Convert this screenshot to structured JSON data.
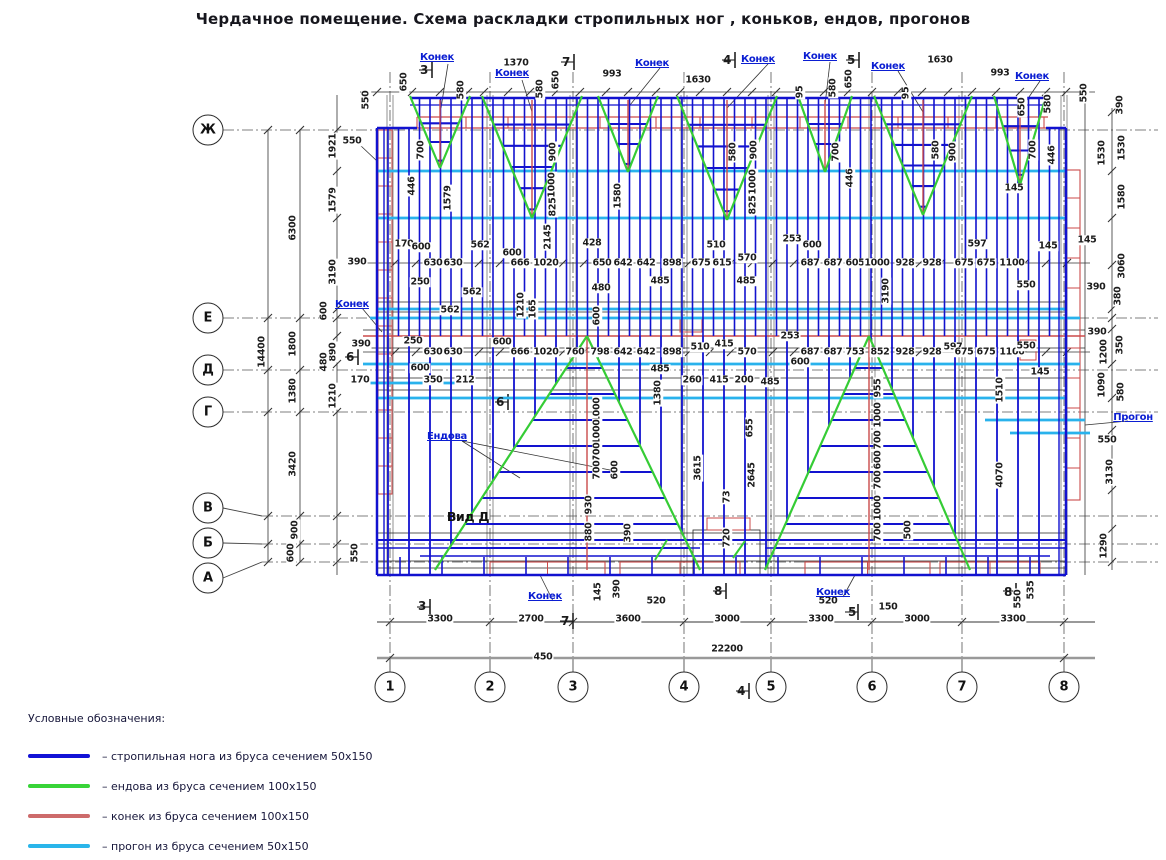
{
  "title": "Чердачное помещение. Схема раскладки стропильных ног , коньков, ендов, прогонов",
  "colors": {
    "rafter": "#1212cf",
    "valley": "#35cc35",
    "ridge": "#cb4a4a",
    "purlin": "#29b2ec",
    "legend_rafter": "#1212d6",
    "legend_valley": "#38d438",
    "legend_ridge": "#cd6b6b",
    "legend_purlin": "#2ab5ea"
  },
  "axes": {
    "rows": [
      {
        "label": "Ж",
        "cx": 208,
        "cy": 130,
        "y": 130
      },
      {
        "label": "Е",
        "cx": 208,
        "cy": 318,
        "y": 318
      },
      {
        "label": "Д",
        "cx": 208,
        "cy": 370,
        "y": 370
      },
      {
        "label": "Г",
        "cx": 208,
        "cy": 412,
        "y": 412
      },
      {
        "label": "В",
        "cx": 208,
        "cy": 508,
        "y": 516
      },
      {
        "label": "Б",
        "cx": 208,
        "cy": 543,
        "y": 544
      },
      {
        "label": "А",
        "cx": 208,
        "cy": 578,
        "y": 562
      }
    ],
    "cols": [
      {
        "label": "1",
        "x": 390
      },
      {
        "label": "2",
        "x": 490
      },
      {
        "label": "3",
        "x": 573
      },
      {
        "label": "4",
        "x": 684
      },
      {
        "label": "5",
        "x": 771
      },
      {
        "label": "6",
        "x": 872
      },
      {
        "label": "7",
        "x": 962
      },
      {
        "label": "8",
        "x": 1064
      }
    ]
  },
  "annotations": [
    {
      "t": "550",
      "x": 366,
      "y": 100,
      "v": 1
    },
    {
      "t": "650",
      "x": 404,
      "y": 82,
      "v": 1
    },
    {
      "t": "580",
      "x": 461,
      "y": 90,
      "v": 1
    },
    {
      "t": "1370",
      "x": 516,
      "y": 63
    },
    {
      "t": "Конек",
      "x": 437,
      "y": 58,
      "c": "b"
    },
    {
      "t": "Конек",
      "x": 512,
      "y": 74,
      "c": "b"
    },
    {
      "t": "580",
      "x": 540,
      "y": 89,
      "v": 1
    },
    {
      "t": "650",
      "x": 556,
      "y": 80,
      "v": 1
    },
    {
      "t": "993",
      "x": 612,
      "y": 74
    },
    {
      "t": "Конек",
      "x": 652,
      "y": 64,
      "c": "b"
    },
    {
      "t": "1630",
      "x": 698,
      "y": 80
    },
    {
      "t": "Конек",
      "x": 758,
      "y": 60,
      "c": "b"
    },
    {
      "t": "Конек",
      "x": 820,
      "y": 57,
      "c": "b"
    },
    {
      "t": "95",
      "x": 800,
      "y": 92,
      "v": 1
    },
    {
      "t": "580",
      "x": 833,
      "y": 88,
      "v": 1
    },
    {
      "t": "650",
      "x": 849,
      "y": 79,
      "v": 1
    },
    {
      "t": "Конек",
      "x": 888,
      "y": 67,
      "c": "b"
    },
    {
      "t": "95",
      "x": 906,
      "y": 93,
      "v": 1
    },
    {
      "t": "1630",
      "x": 940,
      "y": 60
    },
    {
      "t": "993",
      "x": 1000,
      "y": 73
    },
    {
      "t": "Конек",
      "x": 1032,
      "y": 77,
      "c": "b"
    },
    {
      "t": "650",
      "x": 1022,
      "y": 107,
      "v": 1
    },
    {
      "t": "580",
      "x": 1048,
      "y": 104,
      "v": 1
    },
    {
      "t": "550",
      "x": 1084,
      "y": 93,
      "v": 1
    },
    {
      "t": "3",
      "x": 424,
      "y": 70,
      "c": "s"
    },
    {
      "t": "7",
      "x": 566,
      "y": 62,
      "c": "s"
    },
    {
      "t": "4",
      "x": 727,
      "y": 60,
      "c": "s"
    },
    {
      "t": "5",
      "x": 851,
      "y": 60,
      "c": "s"
    },
    {
      "t": "14400",
      "x": 262,
      "y": 352,
      "v": 1
    },
    {
      "t": "6300",
      "x": 293,
      "y": 228,
      "v": 1
    },
    {
      "t": "1800",
      "x": 293,
      "y": 344,
      "v": 1
    },
    {
      "t": "1380",
      "x": 293,
      "y": 391,
      "v": 1
    },
    {
      "t": "3420",
      "x": 293,
      "y": 464,
      "v": 1
    },
    {
      "t": "900",
      "x": 295,
      "y": 530,
      "v": 1
    },
    {
      "t": "600",
      "x": 291,
      "y": 553,
      "v": 1
    },
    {
      "t": "1921",
      "x": 333,
      "y": 146,
      "v": 1
    },
    {
      "t": "1579",
      "x": 333,
      "y": 200,
      "v": 1
    },
    {
      "t": "3190",
      "x": 333,
      "y": 272,
      "v": 1
    },
    {
      "t": "600",
      "x": 324,
      "y": 311,
      "v": 1
    },
    {
      "t": "890",
      "x": 333,
      "y": 352,
      "v": 1
    },
    {
      "t": "480",
      "x": 324,
      "y": 362,
      "v": 1
    },
    {
      "t": "1210",
      "x": 333,
      "y": 396,
      "v": 1
    },
    {
      "t": "550",
      "x": 352,
      "y": 141
    },
    {
      "t": "550",
      "x": 355,
      "y": 553,
      "v": 1
    },
    {
      "t": "390",
      "x": 357,
      "y": 262
    },
    {
      "t": "Конек",
      "x": 352,
      "y": 305,
      "c": "b"
    },
    {
      "t": "390",
      "x": 361,
      "y": 344
    },
    {
      "t": "170",
      "x": 360,
      "y": 380
    },
    {
      "t": "6",
      "x": 350,
      "y": 357,
      "c": "s"
    },
    {
      "t": "700",
      "x": 421,
      "y": 150,
      "v": 1
    },
    {
      "t": "446",
      "x": 412,
      "y": 186,
      "v": 1
    },
    {
      "t": "1579",
      "x": 448,
      "y": 198,
      "v": 1
    },
    {
      "t": "900",
      "x": 553,
      "y": 152,
      "v": 1
    },
    {
      "t": "1000",
      "x": 552,
      "y": 185,
      "v": 1
    },
    {
      "t": "825",
      "x": 553,
      "y": 207,
      "v": 1
    },
    {
      "t": "2145",
      "x": 548,
      "y": 237,
      "v": 1
    },
    {
      "t": "1580",
      "x": 618,
      "y": 196,
      "v": 1
    },
    {
      "t": "580",
      "x": 733,
      "y": 152,
      "v": 1
    },
    {
      "t": "900",
      "x": 754,
      "y": 150,
      "v": 1
    },
    {
      "t": "1000",
      "x": 753,
      "y": 182,
      "v": 1
    },
    {
      "t": "825",
      "x": 753,
      "y": 205,
      "v": 1
    },
    {
      "t": "700",
      "x": 836,
      "y": 152,
      "v": 1
    },
    {
      "t": "446",
      "x": 850,
      "y": 178,
      "v": 1
    },
    {
      "t": "580",
      "x": 936,
      "y": 150,
      "v": 1
    },
    {
      "t": "900",
      "x": 953,
      "y": 152,
      "v": 1
    },
    {
      "t": "145",
      "x": 1014,
      "y": 188
    },
    {
      "t": "700",
      "x": 1033,
      "y": 150,
      "v": 1
    },
    {
      "t": "446",
      "x": 1052,
      "y": 155,
      "v": 1
    },
    {
      "t": "170",
      "x": 404,
      "y": 244
    },
    {
      "t": "600",
      "x": 421,
      "y": 247
    },
    {
      "t": "250",
      "x": 420,
      "y": 282
    },
    {
      "t": "630",
      "x": 433,
      "y": 263
    },
    {
      "t": "630",
      "x": 453,
      "y": 263
    },
    {
      "t": "562",
      "x": 480,
      "y": 245
    },
    {
      "t": "562",
      "x": 472,
      "y": 292
    },
    {
      "t": "562",
      "x": 450,
      "y": 310
    },
    {
      "t": "600",
      "x": 512,
      "y": 253
    },
    {
      "t": "666",
      "x": 520,
      "y": 263
    },
    {
      "t": "1020",
      "x": 546,
      "y": 263
    },
    {
      "t": "428",
      "x": 592,
      "y": 243
    },
    {
      "t": "650",
      "x": 602,
      "y": 263
    },
    {
      "t": "642",
      "x": 623,
      "y": 263
    },
    {
      "t": "642",
      "x": 646,
      "y": 263
    },
    {
      "t": "898",
      "x": 672,
      "y": 263
    },
    {
      "t": "480",
      "x": 601,
      "y": 288
    },
    {
      "t": "485",
      "x": 660,
      "y": 281
    },
    {
      "t": "1210",
      "x": 521,
      "y": 305,
      "v": 1
    },
    {
      "t": "165",
      "x": 533,
      "y": 309,
      "v": 1
    },
    {
      "t": "600",
      "x": 597,
      "y": 316,
      "v": 1
    },
    {
      "t": "510",
      "x": 716,
      "y": 245
    },
    {
      "t": "675",
      "x": 701,
      "y": 263
    },
    {
      "t": "615",
      "x": 722,
      "y": 263
    },
    {
      "t": "570",
      "x": 747,
      "y": 258
    },
    {
      "t": "485",
      "x": 746,
      "y": 281
    },
    {
      "t": "253",
      "x": 792,
      "y": 239
    },
    {
      "t": "600",
      "x": 812,
      "y": 245
    },
    {
      "t": "687",
      "x": 810,
      "y": 263
    },
    {
      "t": "687",
      "x": 833,
      "y": 263
    },
    {
      "t": "605",
      "x": 855,
      "y": 263
    },
    {
      "t": "1000",
      "x": 877,
      "y": 263
    },
    {
      "t": "928",
      "x": 905,
      "y": 263
    },
    {
      "t": "928",
      "x": 932,
      "y": 263
    },
    {
      "t": "3190",
      "x": 886,
      "y": 291,
      "v": 1
    },
    {
      "t": "597",
      "x": 977,
      "y": 244
    },
    {
      "t": "675",
      "x": 964,
      "y": 263
    },
    {
      "t": "675",
      "x": 986,
      "y": 263
    },
    {
      "t": "1100",
      "x": 1012,
      "y": 263
    },
    {
      "t": "550",
      "x": 1026,
      "y": 285
    },
    {
      "t": "145",
      "x": 1048,
      "y": 246
    },
    {
      "t": "390",
      "x": 1096,
      "y": 287
    },
    {
      "t": "250",
      "x": 413,
      "y": 341
    },
    {
      "t": "630",
      "x": 433,
      "y": 352
    },
    {
      "t": "630",
      "x": 453,
      "y": 352
    },
    {
      "t": "600",
      "x": 502,
      "y": 342
    },
    {
      "t": "666",
      "x": 520,
      "y": 352
    },
    {
      "t": "1020",
      "x": 546,
      "y": 352
    },
    {
      "t": "760",
      "x": 575,
      "y": 352
    },
    {
      "t": "798",
      "x": 600,
      "y": 352
    },
    {
      "t": "642",
      "x": 623,
      "y": 352
    },
    {
      "t": "642",
      "x": 646,
      "y": 352
    },
    {
      "t": "898",
      "x": 672,
      "y": 352
    },
    {
      "t": "485",
      "x": 660,
      "y": 369
    },
    {
      "t": "510",
      "x": 700,
      "y": 347
    },
    {
      "t": "415",
      "x": 724,
      "y": 344
    },
    {
      "t": "570",
      "x": 747,
      "y": 352
    },
    {
      "t": "260",
      "x": 692,
      "y": 380
    },
    {
      "t": "415",
      "x": 719,
      "y": 380
    },
    {
      "t": "200",
      "x": 744,
      "y": 380
    },
    {
      "t": "485",
      "x": 770,
      "y": 382
    },
    {
      "t": "253",
      "x": 790,
      "y": 336
    },
    {
      "t": "687",
      "x": 810,
      "y": 352
    },
    {
      "t": "687",
      "x": 833,
      "y": 352
    },
    {
      "t": "753",
      "x": 855,
      "y": 352
    },
    {
      "t": "852",
      "x": 880,
      "y": 352
    },
    {
      "t": "928",
      "x": 905,
      "y": 352
    },
    {
      "t": "928",
      "x": 932,
      "y": 352
    },
    {
      "t": "597",
      "x": 953,
      "y": 347
    },
    {
      "t": "675",
      "x": 964,
      "y": 352
    },
    {
      "t": "675",
      "x": 986,
      "y": 352
    },
    {
      "t": "1100",
      "x": 1012,
      "y": 352
    },
    {
      "t": "550",
      "x": 1026,
      "y": 346
    },
    {
      "t": "145",
      "x": 1040,
      "y": 372
    },
    {
      "t": "600",
      "x": 800,
      "y": 362
    },
    {
      "t": "600",
      "x": 420,
      "y": 368
    },
    {
      "t": "350",
      "x": 433,
      "y": 380
    },
    {
      "t": "212",
      "x": 465,
      "y": 380
    },
    {
      "t": "6",
      "x": 500,
      "y": 402,
      "c": "s"
    },
    {
      "t": "390",
      "x": 1097,
      "y": 332
    },
    {
      "t": "1380",
      "x": 658,
      "y": 393,
      "v": 1
    },
    {
      "t": "1000",
      "x": 597,
      "y": 410,
      "v": 1
    },
    {
      "t": "1000",
      "x": 597,
      "y": 432,
      "v": 1
    },
    {
      "t": "700",
      "x": 597,
      "y": 452,
      "v": 1
    },
    {
      "t": "700",
      "x": 597,
      "y": 470,
      "v": 1
    },
    {
      "t": "600",
      "x": 615,
      "y": 470,
      "v": 1
    },
    {
      "t": "930",
      "x": 589,
      "y": 505,
      "v": 1
    },
    {
      "t": "880",
      "x": 589,
      "y": 532,
      "v": 1
    },
    {
      "t": "390",
      "x": 628,
      "y": 533,
      "v": 1
    },
    {
      "t": "Ендова",
      "x": 447,
      "y": 437,
      "c": "b"
    },
    {
      "t": "Вид Д",
      "x": 468,
      "y": 517,
      "c": "big"
    },
    {
      "t": "3615",
      "x": 698,
      "y": 468,
      "v": 1
    },
    {
      "t": "2645",
      "x": 752,
      "y": 475,
      "v": 1
    },
    {
      "t": "655",
      "x": 750,
      "y": 428,
      "v": 1
    },
    {
      "t": "73",
      "x": 727,
      "y": 497,
      "v": 1
    },
    {
      "t": "720",
      "x": 727,
      "y": 538,
      "v": 1
    },
    {
      "t": "955",
      "x": 878,
      "y": 388,
      "v": 1
    },
    {
      "t": "1000",
      "x": 878,
      "y": 415,
      "v": 1
    },
    {
      "t": "700",
      "x": 878,
      "y": 440,
      "v": 1
    },
    {
      "t": "600",
      "x": 878,
      "y": 460,
      "v": 1
    },
    {
      "t": "700",
      "x": 878,
      "y": 480,
      "v": 1
    },
    {
      "t": "1000",
      "x": 878,
      "y": 508,
      "v": 1
    },
    {
      "t": "700",
      "x": 878,
      "y": 532,
      "v": 1
    },
    {
      "t": "500",
      "x": 908,
      "y": 530,
      "v": 1
    },
    {
      "t": "1510",
      "x": 1000,
      "y": 390,
      "v": 1
    },
    {
      "t": "4070",
      "x": 1000,
      "y": 475,
      "v": 1
    },
    {
      "t": "390",
      "x": 1120,
      "y": 105,
      "v": 1
    },
    {
      "t": "1530",
      "x": 1122,
      "y": 148,
      "v": 1
    },
    {
      "t": "1580",
      "x": 1122,
      "y": 197,
      "v": 1
    },
    {
      "t": "145",
      "x": 1087,
      "y": 240
    },
    {
      "t": "3060",
      "x": 1122,
      "y": 266,
      "v": 1
    },
    {
      "t": "380",
      "x": 1118,
      "y": 296,
      "v": 1
    },
    {
      "t": "350",
      "x": 1120,
      "y": 345,
      "v": 1
    },
    {
      "t": "1200",
      "x": 1104,
      "y": 352,
      "v": 1
    },
    {
      "t": "1090",
      "x": 1102,
      "y": 385,
      "v": 1
    },
    {
      "t": "580",
      "x": 1121,
      "y": 392,
      "v": 1
    },
    {
      "t": "Прогон",
      "x": 1133,
      "y": 418,
      "c": "b"
    },
    {
      "t": "550",
      "x": 1107,
      "y": 440
    },
    {
      "t": "3130",
      "x": 1110,
      "y": 472,
      "v": 1
    },
    {
      "t": "1290",
      "x": 1104,
      "y": 546,
      "v": 1
    },
    {
      "t": "1530",
      "x": 1102,
      "y": 153,
      "v": 1
    },
    {
      "t": "Конек",
      "x": 545,
      "y": 597,
      "c": "b"
    },
    {
      "t": "145",
      "x": 598,
      "y": 592,
      "v": 1
    },
    {
      "t": "390",
      "x": 617,
      "y": 589,
      "v": 1
    },
    {
      "t": "520",
      "x": 656,
      "y": 601
    },
    {
      "t": "8",
      "x": 718,
      "y": 591,
      "c": "s"
    },
    {
      "t": "520",
      "x": 828,
      "y": 601
    },
    {
      "t": "Конек",
      "x": 833,
      "y": 593,
      "c": "b"
    },
    {
      "t": "5",
      "x": 852,
      "y": 612,
      "c": "s"
    },
    {
      "t": "150",
      "x": 888,
      "y": 607
    },
    {
      "t": "535",
      "x": 1031,
      "y": 590,
      "v": 1
    },
    {
      "t": "8",
      "x": 1008,
      "y": 592,
      "c": "s"
    },
    {
      "t": "550",
      "x": 1018,
      "y": 599,
      "v": 1
    },
    {
      "t": "3",
      "x": 422,
      "y": 606,
      "c": "s"
    },
    {
      "t": "7",
      "x": 565,
      "y": 621,
      "c": "s"
    },
    {
      "t": "4",
      "x": 741,
      "y": 691,
      "c": "s"
    },
    {
      "t": "3300",
      "x": 440,
      "y": 619
    },
    {
      "t": "2700",
      "x": 531,
      "y": 619
    },
    {
      "t": "3600",
      "x": 628,
      "y": 619
    },
    {
      "t": "3000",
      "x": 727,
      "y": 619
    },
    {
      "t": "3300",
      "x": 821,
      "y": 619
    },
    {
      "t": "3000",
      "x": 917,
      "y": 619
    },
    {
      "t": "3300",
      "x": 1013,
      "y": 619
    },
    {
      "t": "450",
      "x": 543,
      "y": 657
    },
    {
      "t": "22200",
      "x": 727,
      "y": 649
    }
  ],
  "legend": {
    "heading": "Условные обозначения:",
    "items": [
      {
        "color_key": "legend_rafter",
        "label": "– стропильная нога из бруса сечением 50х150"
      },
      {
        "color_key": "legend_valley",
        "label": "– ендова из бруса сечением 100х150"
      },
      {
        "color_key": "legend_ridge",
        "label": "– конек из бруса сечением 100х150"
      },
      {
        "color_key": "legend_purlin",
        "label": "– прогон из бруса сечением 50х150"
      }
    ]
  }
}
